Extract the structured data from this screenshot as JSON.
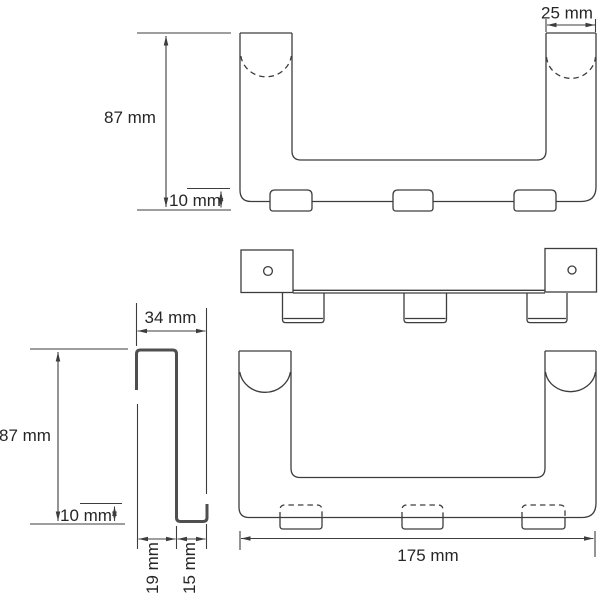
{
  "drawing": {
    "colors": {
      "background": "#ffffff",
      "line": "#3d3d3d",
      "profile_line": "#4f4f4f",
      "text": "#262626"
    },
    "dims": {
      "front_height": "87 mm",
      "front_tab": "10 mm",
      "strip_width": "25 mm",
      "side_depth": "34 mm",
      "side_height": "87 mm",
      "side_lip": "10 mm",
      "side_gap": "19 mm",
      "side_hook": "15 mm",
      "overall_width": "175 mm"
    }
  }
}
